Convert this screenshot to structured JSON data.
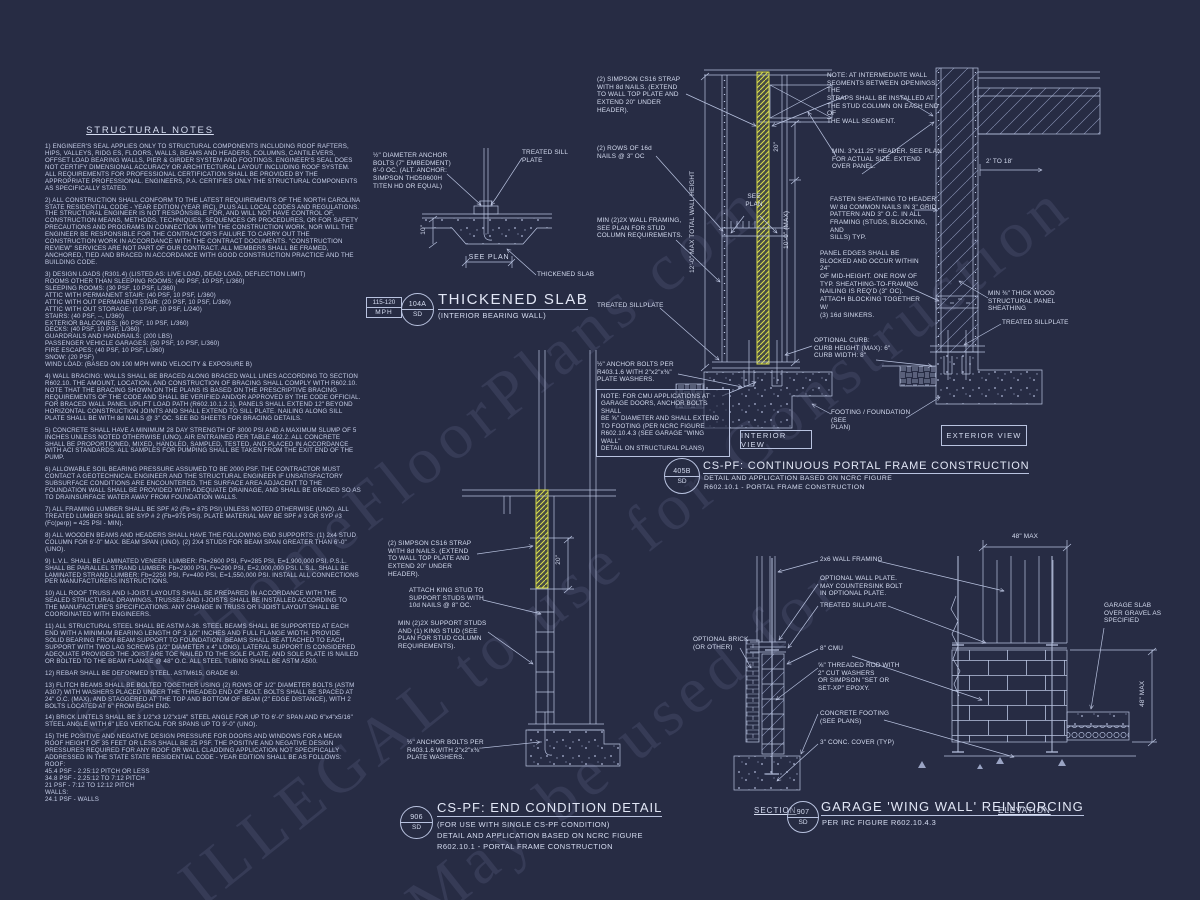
{
  "watermark": {
    "line1": "©MyHomeFloorPlans.com",
    "line2": "ILLEGAL to use for Construction",
    "line3": "May be used for"
  },
  "notes": {
    "title": "STRUCTURAL NOTES",
    "paragraphs": [
      "1) ENGINEER'S SEAL APPLIES ONLY TO STRUCTURAL COMPONENTS INCLUDING ROOF RAFTERS, HIPS, VALLEYS, RIDG ES, FLOORS, WALLS, BEAMS AND HEADERS, COLUMNS, CANTILEVERS, OFFSET LOAD BEARING WALLS, PIER & GIRDER SYSTEM AND FOOTINGS. ENGINEER'S SEAL DOES NOT CERTIFY DIMENSIONAL ACCURACY OR ARCHITECTURAL LAYOUT INCLUDING ROOF SYSTEM. ALL REQUIREMENTS FOR PROFESSIONAL CERTIFICATION SHALL BE PROVIDED BY THE APPROPRIATE PROFESSIONAL. ENGINEERS, P.A. CERTIFIES ONLY THE STRUCTURAL COMPONENTS AS SPECIFICALLY STATED.",
      "2) ALL CONSTRUCTION SHALL CONFORM TO THE LATEST REQUIREMENTS OF THE NORTH CAROLINA STATE RESIDENTIAL CODE - YEAR EDITION (YEAR IRC), PLUS ALL LOCAL CODES AND REGULATIONS. THE STRUCTURAL ENGINEER IS NOT RESPONSIBLE FOR, AND WILL NOT HAVE CONTROL OF, CONSTRUCTION MEANS, METHODS, TECHNIQUES, SEQUENCES OR PROCEDURES, OR FOR SAFETY PRECAUTIONS AND PROGRAMS IN CONNECTION WITH THE CONSTRUCTION WORK, NOR WILL THE ENGINEER BE RESPONSIBLE FOR THE CONTRACTOR'S FAILURE TO CARRY OUT THE CONSTRUCTION WORK IN ACCORDANCE WITH THE CONTRACT DOCUMENTS. \"CONSTRUCTION REVIEW\" SERVICES ARE NOT PART OF OUR CONTRACT. ALL MEMBERS SHALL BE FRAMED, ANCHORED, TIED AND BRACED IN ACCORDANCE WITH GOOD CONSTRUCTION PRACTICE AND THE BUILDING CODE.",
      "3) DESIGN LOADS (R301.4) (LISTED AS: LIVE LOAD, DEAD LOAD, DEFLECTION LIMIT)\nROOMS OTHER THAN SLEEPING ROOMS: (40 PSF, 10 PSF, L/360)\nSLEEPING ROOMS: (30 PSF, 10 PSF, L/360)\nATTIC WITH PERMANENT STAIR: (40 PSF, 10 PSF, L/360)\nATTIC WITH OUT PERMANENT STAIR: (20 PSF, 10 PSF, L/360)\nATTIC WITH OUT STORAGE: (10 PSF, 10 PSF, L/240)\nSTAIRS: (40 PSF, --, L/360)\nEXTERIOR BALCONIES: (60 PSF, 10 PSF, L/360)\nDECKS: (40 PSF, 10 PSF, L/360)\nGUARDRAILS AND HANDRAILS: (200 LBS)\nPASSENGER VEHICLE GARAGES: (50 PSF, 10 PSF, L/360)\nFIRE ESCAPES: (40 PSF, 10 PSF, L/360)\nSNOW: (20 PSF)\nWIND LOAD: (BASED ON 100 MPH WIND VELOCITY & EXPOSURE B)",
      "4) WALL BRACING:  WALLS SHALL BE BRACED ALONG BRACED WALL LINES ACCORDING TO SECTION R602.10. THE AMOUNT, LOCATION, AND CONSTRUCTION OF BRACING SHALL COMPLY WITH R602.10. NOTE THAT THE BRACING SHOWN ON THE PLANS IS BASED ON THE PRESCRIPTIVE BRACING REQUIREMENTS OF THE CODE AND SHALL BE VERIFIED AND/OR APPROVED BY THE CODE OFFICIAL. FOR BRACED WALL PANEL UPLIFT LOAD PATH (R602.10.1.2.1), PANELS SHALL EXTEND 12\" BEYOND HORIZONTAL CONSTRUCTION JOINTS AND SHALL EXTEND TO SILL PLATE. NAILING ALONG SILL PLATE SHALL BE WITH 8d NAILS @ 3\" OC. SEE BD SHEETS FOR BRACING DETAILS.",
      "5) CONCRETE SHALL HAVE A MINIMUM 28 DAY STRENGTH OF 3000 PSI AND A MAXIMUM SLUMP OF 5 INCHES UNLESS NOTED OTHERWISE (UNO). AIR ENTRAINED PER TABLE 402.2. ALL CONCRETE SHALL BE PROPORTIONED, MIXED, HANDLED, SAMPLED, TESTED, AND PLACED IN ACCORDANCE WITH ACI STANDARDS. ALL SAMPLES FOR PUMPING SHALL BE TAKEN FROM THE EXIT END OF THE PUMP.",
      "6) ALLOWABLE SOIL BEARING PRESSURE ASSUMED TO BE 2000 PSF. THE CONTRACTOR MUST CONTACT A GEOTECHNICAL ENGINEER AND THE STRUCTURAL ENGINEER IF UNSATISFACTORY SUBSURFACE CONDITIONS ARE ENCOUNTERED. THE SURFACE AREA ADJACENT TO THE FOUNDATION WALL SHALL BE PROVIDED WITH ADEQUATE DRAINAGE, AND SHALL BE GRADED SO AS TO DRAINSURFACE WATER AWAY FROM FOUNDATION WALLS.",
      "7) ALL FRAMING LUMBER SHALL BE SPF #2 (Fb = 875 PSI) UNLESS NOTED OTHERWISE (UNO). ALL TREATED LUMBER SHALL BE SYP # 2 (Fb=975 PSI). PLATE MATERIAL MAY BE SPF # 3 OR SYP #3 (Fc(perp) = 425 PSI - MIN).",
      "8) ALL WOODEN BEAMS AND HEADERS SHALL HAVE THE FOLLOWING END SUPPORTS: (1) 2x4 STUD COLUMN FOR 6'-0\" MAX. BEAM SPAN (UNO). (2) 2X4 STUDS FOR BEAM SPAN GREATER THAN 6'-0\" (UNO).",
      "9) L.V.L.  SHALL BE LAMINATED VENEER LUMBER: Fb=2600 PSI, Fv=285 PSI, E=1,900,000 PSI. P.S.L.  SHALL BE PARALLEL STRAND LUMBER: Fb=2900 PSI, Fv=290 PSI, E=2,000,000 PSI. L.S.L.  SHALL BE LAMINATED STRAND LUMBER: Fb=2250 PSI, Fv=400 PSI, E=1,550,000 PSI. INSTALL ALL CONNECTIONS PER MANUFACTURERS INSTRUCTIONS.",
      "10) ALL ROOF TRUSS AND I-JOIST LAYOUTS SHALL BE PREPARED IN ACCORDANCE WITH THE SEALED STRUCTURAL DRAWINGS. TRUSSES AND I-JOISTS SHALL BE INSTALLED ACCORDING TO THE MANUFACTURE'S SPECIFICATIONS. ANY CHANGE IN TRUSS OR I-JOIST LAYOUT SHALL BE COORDINATED WITH  ENGINEERS.",
      "11) ALL STRUCTURAL STEEL SHALL BE ASTM A-36. STEEL BEAMS SHALL BE SUPPORTED AT EACH END WITH A MINIMUM BEARING LENGTH OF 3 1/2\" INCHES AND FULL FLANGE WIDTH. PROVIDE SOLID BEARING FROM BEAM SUPPORT TO FOUNDATION.  BEAMS SHALL BE ATTACHED TO EACH SUPPORT WITH TWO LAG SCREWS (1/2\" DIAMETER x 4\" LONG). LATERAL SUPPORT IS CONSIDERED ADEQUATE PROVIDED THE JOIST ARE TOE NAILED TO THE SOLE PLATE, AND SOLE PLATE IS NAILED OR BOLTED TO THE BEAM FLANGE @ 48\" O.C. ALL STEEL TUBING SHALL BE ASTM A500.",
      "12) REBAR SHALL BE DEFORMED STEEL. ASTM615, GRADE 60.",
      "13) FLITCH BEAMS SHALL BE BOLTED TOGETHER USING (2) ROWS OF 1/2\" DIAMETER BOLTS (ASTM A307) WITH WASHERS PLACED UNDER THE THREADED END OF BOLT. BOLTS SHALL BE SPACED AT 24\" O.C. (MAX), AND STAGGERED AT THE TOP AND BOTTOM OF BEAM (2\" EDGE DISTANCE), WITH 2 BOLTS LOCATED AT 6\" FROM EACH END.",
      "14) BRICK LINTELS SHALL BE 3 1/2\"x3 1/2\"x1/4\" STEEL ANGLE FOR UP TO 6'-0\" SPAN AND 6\"x4\"x5/16\" STEEL ANGLE WITH 6\" LEG VERTICAL FOR SPANS UP TO 9'-0\" (UNO).",
      "15) THE POSITIVE AND NEGATIVE DESIGN PRESSURE FOR DOORS AND WINDOWS FOR A MEAN ROOF HEIGHT OF 35 FEET OR LESS SHALL BE 25 PSF. THE POSITIVE AND NEGATIVE DESIGN PRESSURES REQUIRED FOR ANY ROOF OR WALL CLADDING APPLICATION NOT SPECIFICALLY ADDRESSED IN THE STATE STATE RESIDENTIAL CODE - YEAR EDITION SHALL BE AS FOLLOWS:\nROOF:\n45.4 PSF - 2.25:12 PITCH OR LESS\n34.8 PSF - 2.25:12 TO 7:12 PITCH\n21 PSF - 7:12 TO 12:12 PITCH\nWALLS:\n24.1 PSF - WALLS"
    ]
  },
  "thickened_slab": {
    "wind_rating_line1": "115-120",
    "wind_rating_line2": "MPH",
    "badge_id": "104A",
    "badge_discipline": "SD",
    "title": "THICKENED SLAB",
    "subtitle": "(INTERIOR BEARING WALL)",
    "label_anchor_bolts": "½\" DIAMETER ANCHOR\nBOLTS (7\" EMBEDMENT)\n6'-0 OC. (ALT. ANCHOR:\nSIMPSON THD50600H\nTITEN HD OR EQUAL)",
    "label_treated_sill_plate": "TREATED SILL\nPLATE",
    "label_thickened_slab": "THICKENED SLAB",
    "dim_depth": "10\"",
    "dim_see_plan": "SEE PLAN"
  },
  "portal_frame": {
    "badge_id": "405B",
    "badge_discipline": "SD",
    "title": "CS-PF: CONTINUOUS PORTAL FRAME CONSTRUCTION",
    "subtitle1": "DETAIL AND APPLICATION BASED ON NCRC FIGURE",
    "subtitle2": "R602.10.1 - PORTAL FRAME CONSTRUCTION",
    "label_strap": "(2) SIMPSON CS16 STRAP\nWITH 8d NAILS. (EXTEND\nTO WALL TOP PLATE AND\nEXTEND 20\" UNDER\nHEADER).",
    "label_16d_nails": "(2) ROWS OF 16d\nNAILS @ 3\" OC",
    "label_min_framing": "MIN (2)2X WALL FRAMING,\nSEE PLAN FOR STUD\nCOLUMN REQUIREMENTS.",
    "label_treated_sillplate_interior": "TREATED SILLPLATE",
    "label_anchor_bolts": "½\" ANCHOR BOLTS PER\nR403.1.6 WITH 2\"x2\"x⅜\"\nPLATE WASHERS.",
    "note_cmu": "NOTE: FOR CMU APPLICATIONS AT\nGARAGE DOORS, ANCHOR BOLTS SHALL\nBE ⅝\" DIAMETER AND SHALL EXTEND\nTO FOOTING (PER NCRC FIGURE\nR602.10.4.3 (SEE GARAGE \"WING WALL\"\nDETAIL ON STRUCTURAL PLANS)",
    "note_intermediate": "NOTE: AT INTERMEDIATE WALL\nSEGMENTS BETWEEN OPENINGS, THE\nSTRAPS SHALL BE INSTALLED AT\nTHE STUD COLUMN ON EACH END OF\nTHE WALL SEGMENT.",
    "label_header": "MIN. 3\"x11.25\" HEADER. SEE PLAN\nFOR ACTUAL SIZE. EXTEND\nOVER PANEL.",
    "label_fasten": "FASTEN SHEATHING TO HEADER\nW/ 8d COMMON NAILS IN 3\" GRID\nPATTERN AND 3\" O.C. IN ALL\nFRAMING (STUDS, BLOCKING, AND\nSILLS) TYP.",
    "label_panel_edges": "PANEL EDGES SHALL BE\nBLOCKED AND OCCUR WITHIN 24\"\nOF MID-HEIGHT.  ONE ROW OF\nTYP. SHEATHING-TO-FRAMING\nNAILING IS REQ'D (3\" OC).\nATTACH BLOCKING TOGETHER W/\n(3) 16d SINKERS.",
    "label_sheathing": "MIN ⅜\" THICK WOOD\nSTRUCTURAL PANEL\nSHEATHING",
    "label_treated_sillplate_exterior": "TREATED SILLPLATE",
    "label_curb": "OPTIONAL CURB:\nCURB HEIGHT (MAX): 6\"\nCURB WIDTH: 8\"",
    "label_footing": "FOOTING / FOUNDATION (SEE\nPLAN)",
    "dim_total_height": "12'-0\" MAX TOTAL WALL HEIGHT",
    "dim_10ft": "10'-0\" (MAX)",
    "dim_20in": "20\"",
    "dim_2to18": "2' TO 18'",
    "dim_see_plan": "SEE\nPLAN",
    "view_interior": "INTERIOR VIEW",
    "view_exterior": "EXTERIOR VIEW"
  },
  "end_condition": {
    "badge_id": "906",
    "badge_discipline": "SD",
    "title": "CS-PF: END CONDITION DETAIL",
    "subtitle1": "(FOR USE WITH SINGLE CS-PF CONDITION)",
    "subtitle2": "DETAIL AND APPLICATION BASED ON NCRC FIGURE",
    "subtitle3": "R602.10.1 - PORTAL FRAME CONSTRUCTION",
    "label_strap": "(2) SIMPSON CS16 STRAP\nWITH 8d NAILS. (EXTEND\nTO WALL TOP PLATE AND\nEXTEND 20\" UNDER\nHEADER).",
    "label_attach_king": "ATTACH KING STUD TO\nSUPPORT STUDS WITH\n10d NAILS @ 8\" OC.",
    "label_min_support": "MIN (2)2X SUPPORT STUDS\nAND (1) KING STUD (SEE\nPLAN FOR STUD COLUMN\nREQUIREMENTS).",
    "label_anchor_bolts": "½\" ANCHOR BOLTS PER\nR403.1.6 WITH 2\"x2\"x⅜\"\nPLATE WASHERS.",
    "dim_20in": "20\""
  },
  "wing_wall": {
    "badge_id": "907",
    "badge_discipline": "SD",
    "title": "GARAGE 'WING WALL' REINFORCING",
    "subtitle": "PER IRC FIGURE R602.10.4.3",
    "label_framing": "2x6 WALL FRAMING",
    "label_opt_plate": "OPTIONAL WALL PLATE.\nMAY COUNTERSINK BOLT\nIN OPTIONAL PLATE.",
    "label_treated_sillplate": "TREATED SILLPLATE",
    "label_opt_brick": "OPTIONAL BRICK\n(OR OTHER)",
    "label_cmu": "8\" CMU",
    "label_rod": "⅝\" THREADED ROD WITH\n2\" CUT WASHERS\nOR SIMPSON \"SET OR\nSET-XP\" EPOXY.",
    "label_footing": "CONCRETE FOOTING\n(SEE PLANS)",
    "label_cover": "3\" CONC. COVER (TYP)",
    "label_slab": "GARAGE SLAB\nOVER GRAVEL AS\nSPECIFIED",
    "dim_width": "48\" MAX",
    "dim_height": "48\" MAX",
    "view_section": "SECTION",
    "view_elevation": "ELEVATION"
  }
}
